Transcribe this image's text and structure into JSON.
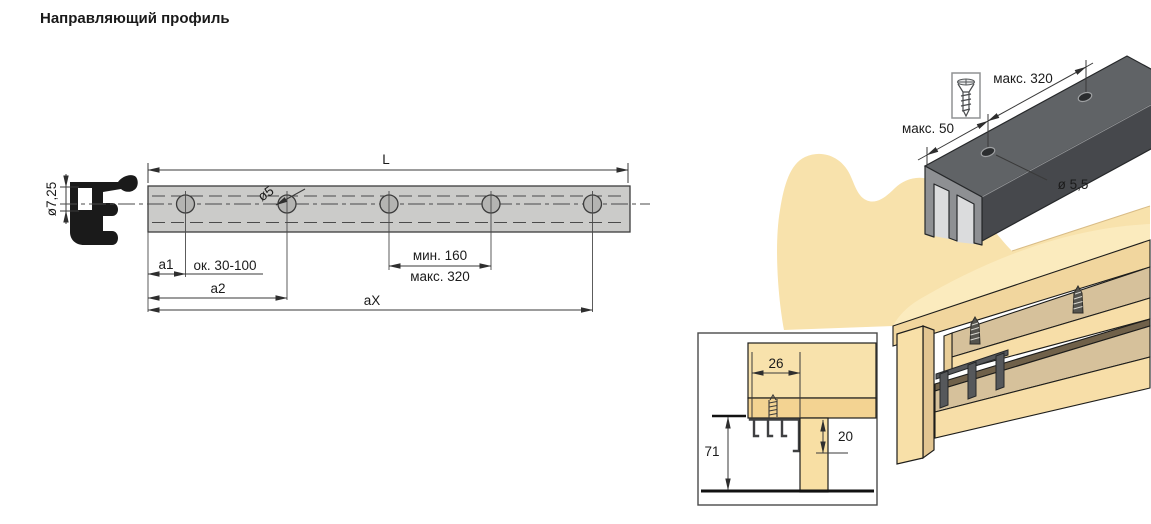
{
  "title": "Направляющий профиль",
  "plan_view": {
    "labels": {
      "length": "L",
      "hole_dia": "ø5",
      "profile_slot_dia": "ø7,25",
      "a1": "a1",
      "a1_range": "ок. 30-100",
      "a2": "a2",
      "aX": "aX",
      "spacing_min": "мин. 160",
      "spacing_max": "макс. 320"
    }
  },
  "iso_view": {
    "labels": {
      "end_offset": "макс. 50",
      "hole_spacing": "макс. 320",
      "hole_dia": "ø 5,5"
    }
  },
  "detail_view": {
    "labels": {
      "inset_depth": "26",
      "front_height": "71",
      "clearance": "20"
    }
  },
  "colors": {
    "wood_light": "#F8E2AC",
    "wood_mid": "#D6C19B",
    "wood_edge": "#F1D69E",
    "wood_shadow": "#70614A",
    "rail_gray": "#CBCBC9",
    "profile_dark": "#46484C",
    "profile_top": "#606366",
    "line": "#1d1d1b"
  }
}
